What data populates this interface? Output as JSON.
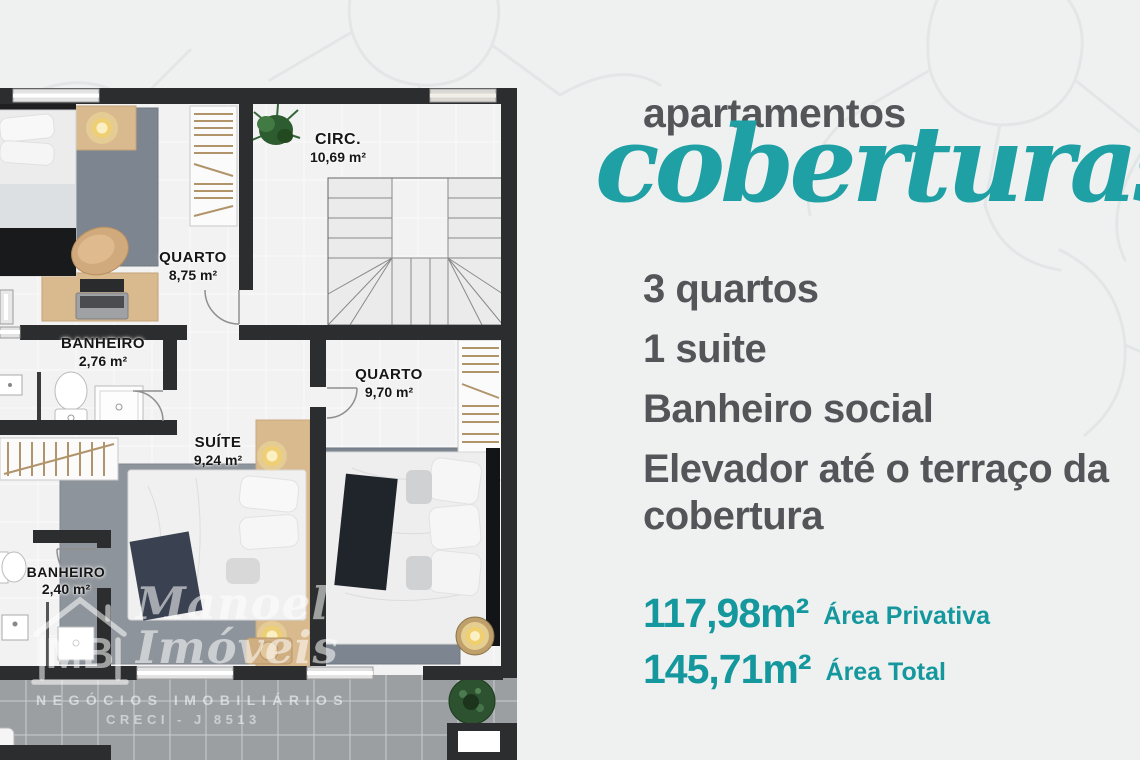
{
  "title": {
    "line1": "apartamentos",
    "line2": "coberturas"
  },
  "features": [
    "3 quartos",
    "1 suite",
    "Banheiro social",
    "Elevador até o terraço da cobertura"
  ],
  "areas": {
    "privativa": {
      "value": "117,98m²",
      "label": "Área Privativa"
    },
    "total": {
      "value": "145,71m²",
      "label": "Área Total"
    }
  },
  "floorplan": {
    "rooms": [
      {
        "name": "CIRC.",
        "area": "10,69 m²"
      },
      {
        "name": "QUARTO",
        "area": "8,75 m²"
      },
      {
        "name": "BANHEIRO",
        "area": "2,76 m²"
      },
      {
        "name": "QUARTO",
        "area": "9,70 m²"
      },
      {
        "name": "SUÍTE",
        "area": "9,24 m²"
      },
      {
        "name": "BANHEIRO",
        "area": "2,40 m²"
      }
    ]
  },
  "watermark": {
    "initials": "MB",
    "name_line1": "Manoel",
    "name_line2": "Imóveis",
    "tagline": "NEGÓCIOS IMOBILIÁRIOS",
    "registration": "CRECI - J 8513"
  },
  "colors": {
    "accent_teal": "#14989d",
    "title_script_teal": "#1fa0a4",
    "text_dark": "#545559",
    "background": "#eff1f1",
    "wall_dark": "#2c2d2e",
    "terrace_gray": "#9b9fa2"
  }
}
